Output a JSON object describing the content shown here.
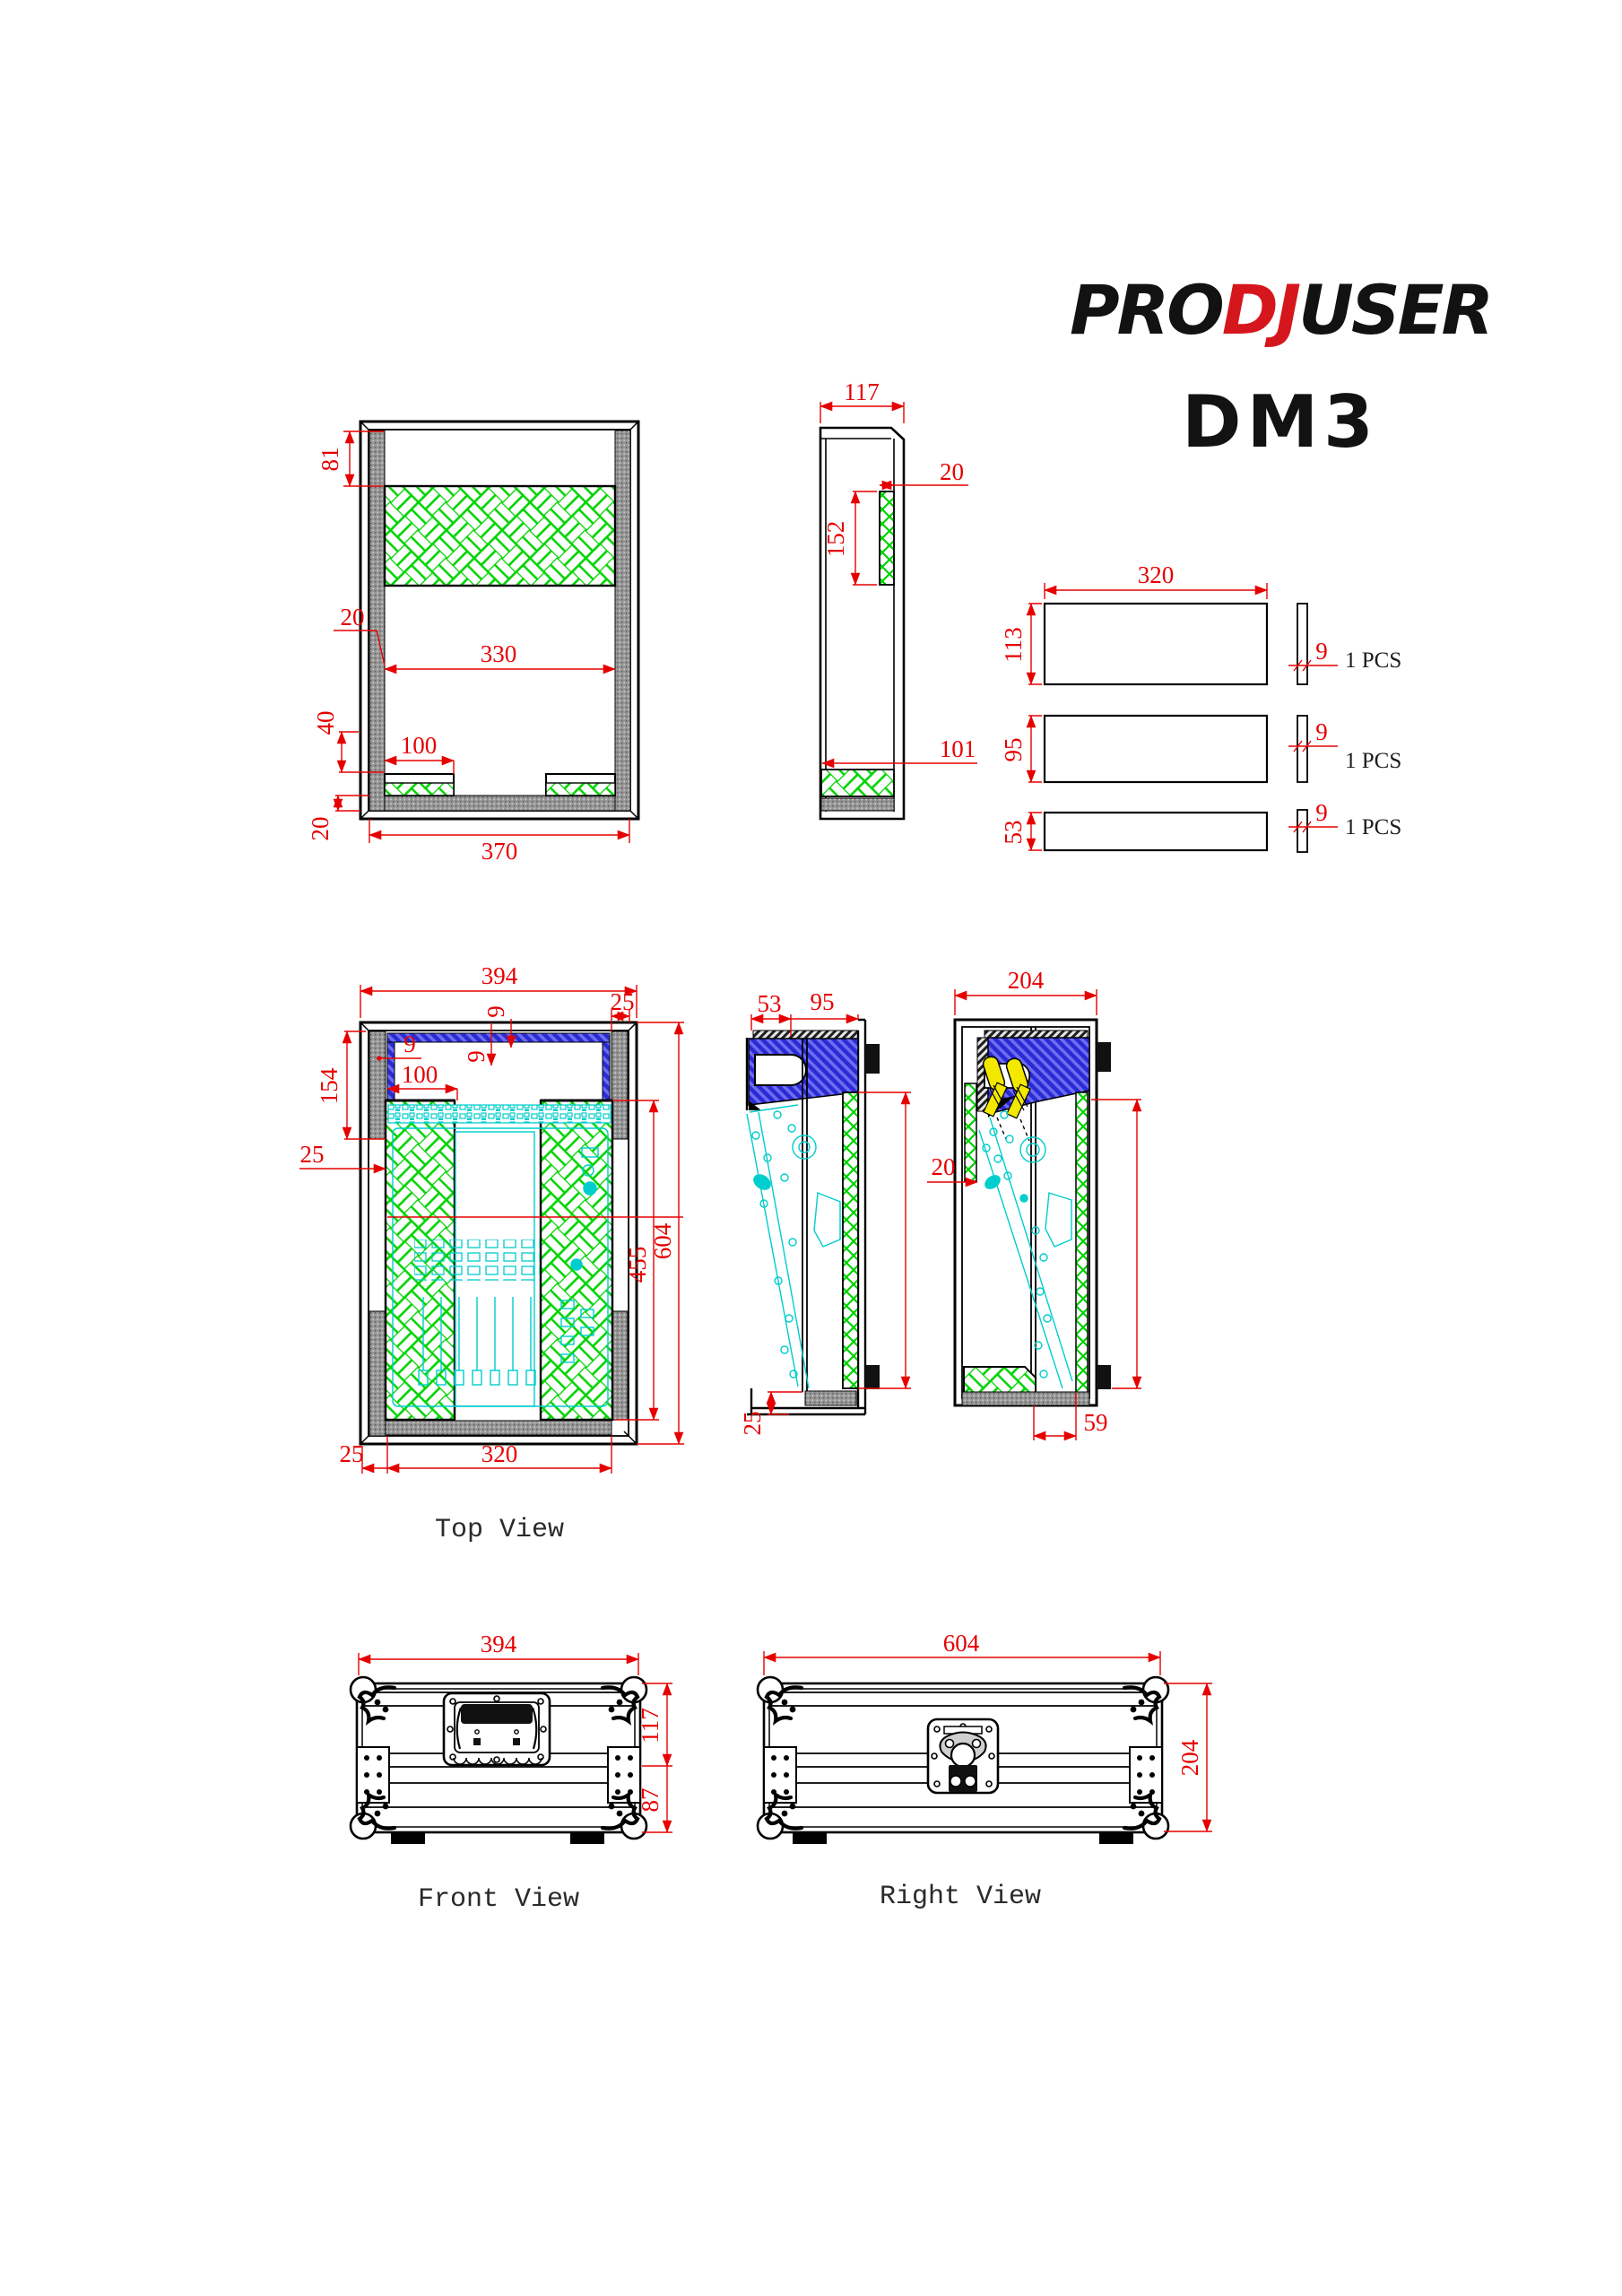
{
  "logo": {
    "pro": "PRO",
    "dj": "DJ",
    "user": "USER",
    "model": "DM3"
  },
  "titles": {
    "top": "Top View",
    "front": "Front View",
    "right": "Right View"
  },
  "panels": {
    "pcs_a": "1 PCS",
    "pcs_b": "1 PCS",
    "pcs_c": "1 PCS"
  },
  "colors": {
    "dimension_red": "#e60000",
    "foam_green": "#00d300",
    "equipment_cyan": "#00cdcd",
    "lid_foam_blue": "#2b2bd5",
    "latch_yellow": "#f2e800",
    "wall_gray": "#969696",
    "line_black": "#000000",
    "logo_red": "#d6161d"
  },
  "dims": {
    "a81": "81",
    "a20wall": "20",
    "a330": "330",
    "a40": "40",
    "a100": "100",
    "a20bot": "20",
    "a370": "370",
    "b117": "117",
    "b20": "20",
    "b152": "152",
    "b101": "101",
    "c320": "320",
    "c113": "113",
    "c95": "95",
    "c53": "53",
    "c9a": "9",
    "c9b": "9",
    "c9c": "9",
    "d394": "394",
    "d25tr": "25",
    "d9a": "9",
    "d9b": "9",
    "d9c": "9",
    "d100": "100",
    "d154": "154",
    "d25l": "25",
    "d604": "604",
    "d455": "455",
    "d25bl": "25",
    "d320": "320",
    "e53": "53",
    "e95": "95",
    "e25": "25",
    "f204": "204",
    "f20": "20",
    "f59": "59",
    "g394": "394",
    "g117": "117",
    "g87": "87",
    "h604": "604",
    "h204": "204"
  }
}
